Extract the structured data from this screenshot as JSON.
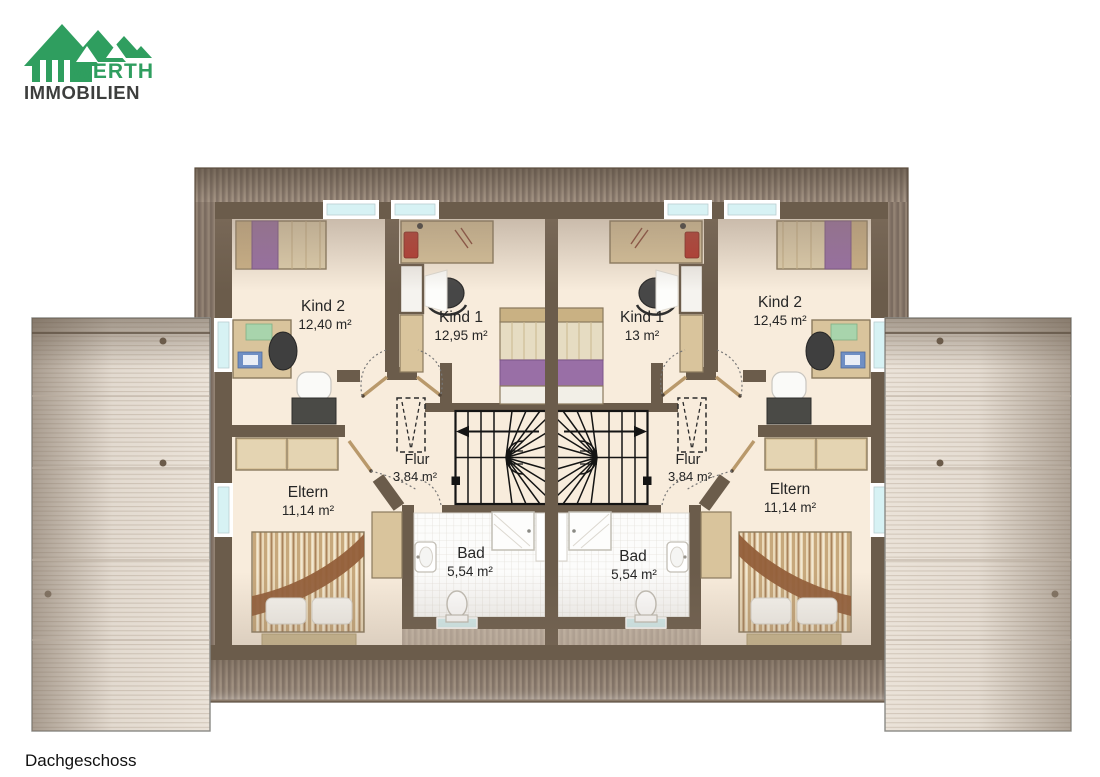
{
  "brand": {
    "name": "WERTH",
    "subtitle": "IMMOBILIEN"
  },
  "floor_label": "Dachgeschoss",
  "units": {
    "left": {
      "kind2_name": "Kind 2",
      "kind2_area": "12,40 m²",
      "kind1_name": "Kind 1",
      "kind1_area": "12,95 m²",
      "eltern_name": "Eltern",
      "eltern_area": "11,14 m²",
      "flur_name": "Flur",
      "flur_area": "3,84 m²",
      "bad_name": "Bad",
      "bad_area": "5,54 m²"
    },
    "right": {
      "kind1_name": "Kind 1",
      "kind1_area": "13 m²",
      "kind2_name": "Kind 2",
      "kind2_area": "12,45 m²",
      "eltern_name": "Eltern",
      "eltern_area": "11,14 m²",
      "flur_name": "Flur",
      "flur_area": "3,84 m²",
      "bad_name": "Bad",
      "bad_area": "5,54 m²"
    }
  },
  "colors": {
    "brand_green": "#2f9e5f",
    "brand_dark": "#3d3e3d",
    "wall": "#6b5c4b",
    "floor": "#f8ecdc",
    "window_glass": "#d7f2f4",
    "roof_dark": "#8a7a6a",
    "roof_light": "#ebe3d9",
    "wood": "#d9c49c",
    "accent_purple": "#996fa6",
    "stair_line": "#141414"
  }
}
